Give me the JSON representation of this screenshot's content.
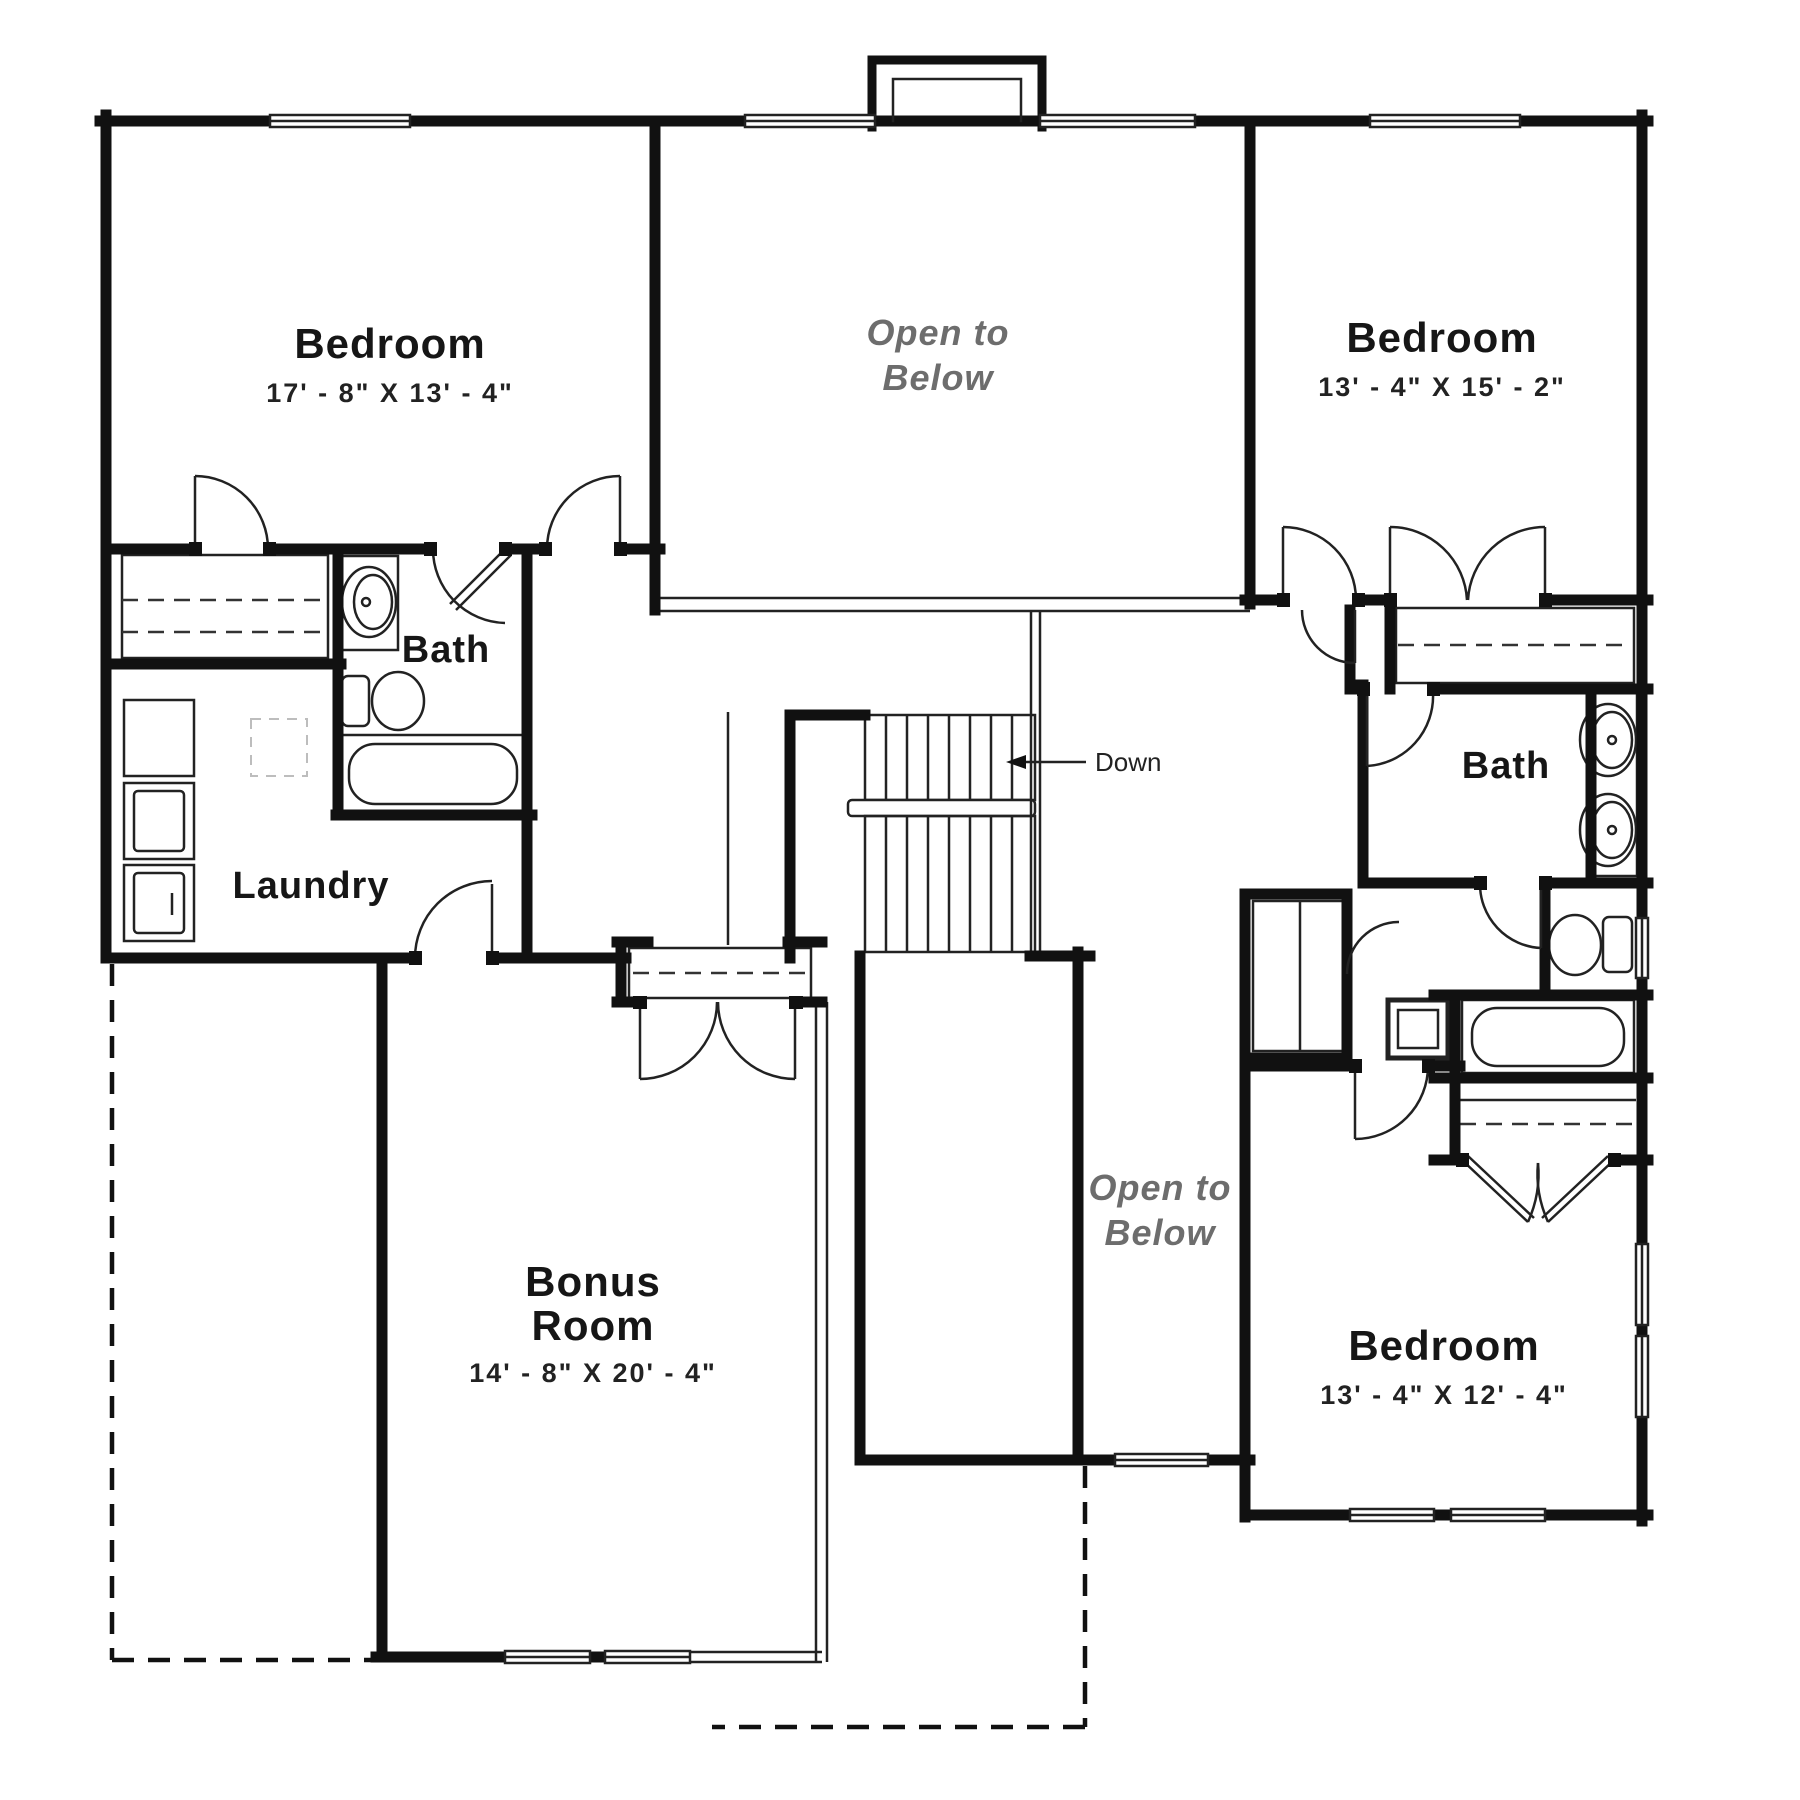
{
  "plan": {
    "type": "floor-plan",
    "floor": "upper",
    "rooms": {
      "bedroom_top_left": {
        "name": "Bedroom",
        "dims": "17' - 8\"  X  13' - 4\""
      },
      "bedroom_top_right": {
        "name": "Bedroom",
        "dims": "13' - 4\"  X  15' - 2\""
      },
      "bedroom_bottom_right": {
        "name": "Bedroom",
        "dims": "13' - 4\"  X  12' - 4\""
      },
      "bonus_room": {
        "name_line1": "Bonus",
        "name_line2": "Room",
        "dims": "14' - 8\"  X  20' - 4\""
      },
      "bath_left": {
        "name": "Bath"
      },
      "bath_right": {
        "name": "Bath"
      },
      "laundry": {
        "name": "Laundry"
      },
      "open_to_below_top": {
        "line1": "Open to",
        "line2": "Below"
      },
      "open_to_below_bottom": {
        "line1": "Open to",
        "line2": "Below"
      },
      "stairs": {
        "label": "Down"
      }
    },
    "colors": {
      "wall": "#111111",
      "text": "#161616",
      "muted": "#6d6d6d"
    }
  }
}
